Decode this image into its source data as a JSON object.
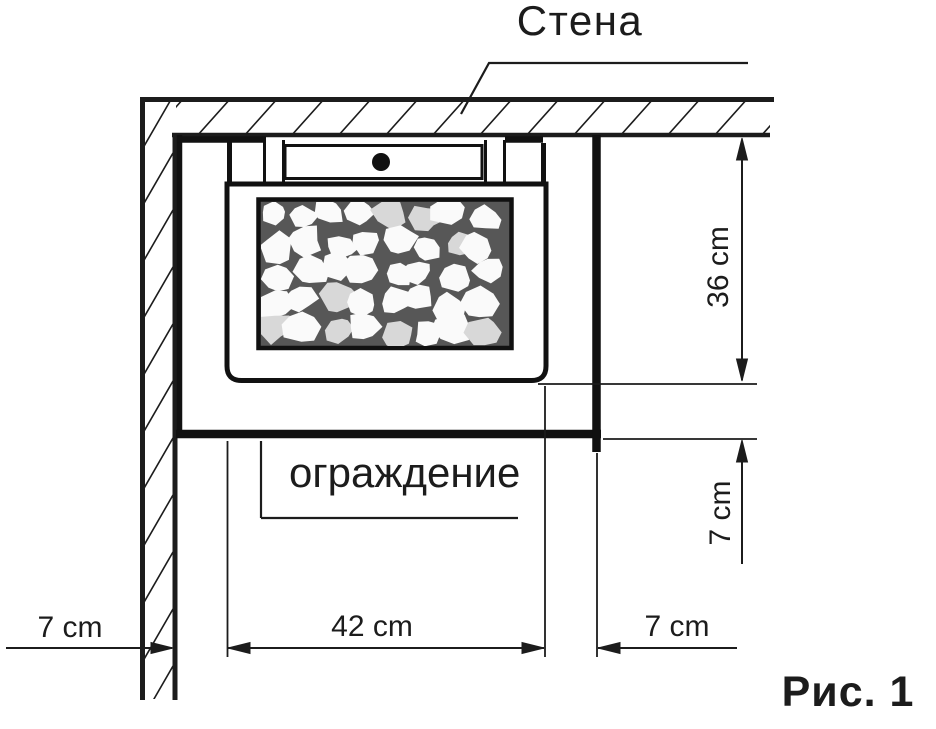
{
  "labels": {
    "wall": "Стена",
    "guard": "ограждение",
    "caption": "Рис. 1"
  },
  "dimensions": {
    "wall_to_heater_left": "7 cm",
    "heater_width": "42 cm",
    "heater_to_guard_right": "7 cm",
    "wall_to_heater_front": "36 cm",
    "heater_to_guard_front": "7 cm"
  },
  "colors": {
    "line": "#1c1c1c",
    "background": "#ffffff",
    "stone_bed": "#575757",
    "stone": "#fafafa",
    "stone_alt": "#d8d8d8"
  }
}
